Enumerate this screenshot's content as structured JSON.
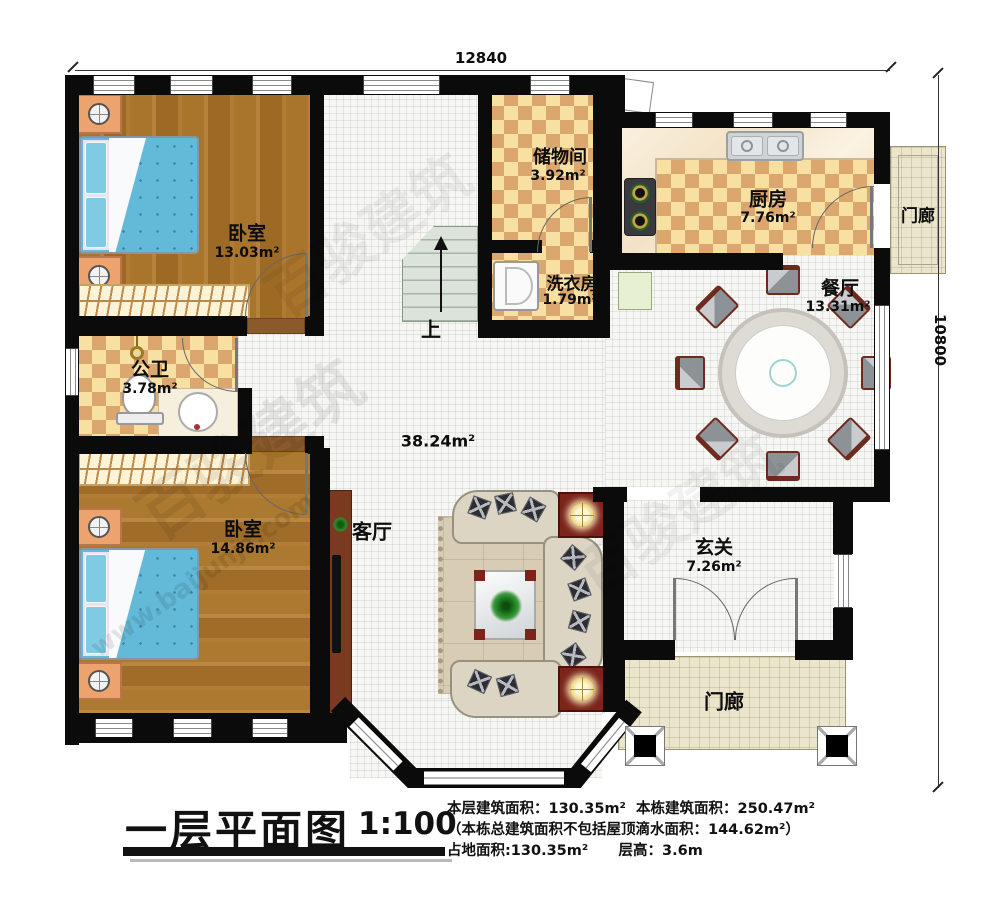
{
  "dimensions": {
    "top": "12840",
    "right": "10800"
  },
  "rooms": {
    "bedroom1": {
      "name": "卧室",
      "area": "13.03m²"
    },
    "storage": {
      "name": "储物间",
      "area": "3.92m²"
    },
    "kitchen": {
      "name": "厨房",
      "area": "7.76m²"
    },
    "porch_right": {
      "name": "门廊"
    },
    "laundry": {
      "name": "洗衣房",
      "area": "1.79m²"
    },
    "dining": {
      "name": "餐厅",
      "area": "13.31m²"
    },
    "bathroom": {
      "name": "公卫",
      "area": "3.78m²"
    },
    "living": {
      "name": "客厅",
      "area": "38.24m²"
    },
    "bedroom2": {
      "name": "卧室",
      "area": "14.86m²"
    },
    "foyer": {
      "name": "玄关",
      "area": "7.26m²"
    },
    "porch_bottom": {
      "name": "门廊"
    }
  },
  "stairs": {
    "up": "上"
  },
  "title_block": {
    "title": "一层平面图",
    "scale": "1:100",
    "line1a": "本层建筑面积：130.35m²",
    "line1b": "本栋建筑面积：250.47m²",
    "line2": "（本栋总建筑面积不包括屋顶滴水面积：144.62m²）",
    "line3a": "占地面积:130.35m²",
    "line3b": "层高：3.6m"
  },
  "watermark": {
    "brand": "百骏建筑",
    "url": "www.baijunjz.com"
  }
}
